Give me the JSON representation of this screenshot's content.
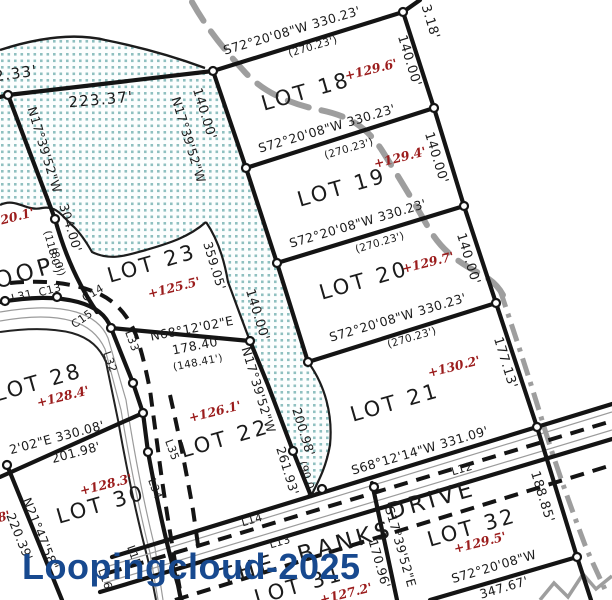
{
  "title": "Subdivision Plat Map",
  "watermark": {
    "text": "Loopingcloud-2025",
    "color": "#17498f"
  },
  "colors": {
    "line_black": "#141414",
    "stipple_teal": "#8fc0c0",
    "stream_gray": "#9e9e9e",
    "elevation_red": "#9b1c1c",
    "background": "#ffffff"
  },
  "streets": [
    "OOP",
    "THE BANKS DRIVE"
  ],
  "lots": [
    {
      "name": "LOT 18",
      "elevation": "+129.6'"
    },
    {
      "name": "LOT 19",
      "elevation": "+129.4'"
    },
    {
      "name": "LOT 20",
      "elevation": "+129.7'"
    },
    {
      "name": "LOT 21",
      "elevation": "+130.2'"
    },
    {
      "name": "LOT 22",
      "elevation": "+126.1'"
    },
    {
      "name": "LOT 23",
      "elevation": "+125.5'"
    },
    {
      "name": "LOT 28",
      "elevation": "+128.4'"
    },
    {
      "name": "LOT 30",
      "elevation": "+128.3'"
    },
    {
      "name": "LOT 31",
      "elevation": "+127.2'"
    },
    {
      "name": "LOT 32",
      "elevation": "+129.5'"
    }
  ],
  "map": {
    "labels": [
      {
        "text": "S72°20'08\"W 330.23'",
        "x": 292,
        "y": 31,
        "rot": -16.5,
        "cls": "b"
      },
      {
        "text": "(270.23')",
        "x": 313,
        "y": 47,
        "rot": -16.5,
        "cls": "p"
      },
      {
        "text": "S72°20'08\"W 330.23'",
        "x": 327,
        "y": 129,
        "rot": -16.5,
        "cls": "b"
      },
      {
        "text": "(270.23')",
        "x": 349,
        "y": 149,
        "rot": -16.5,
        "cls": "p"
      },
      {
        "text": "S72°20'08\"W 330.23'",
        "x": 358,
        "y": 224,
        "rot": -16.5,
        "cls": "b"
      },
      {
        "text": "(270.23')",
        "x": 380,
        "y": 243,
        "rot": -16.5,
        "cls": "p"
      },
      {
        "text": "S72°20'08\"W 330.23'",
        "x": 398,
        "y": 318,
        "rot": -16.5,
        "cls": "b"
      },
      {
        "text": "(270.23')",
        "x": 412,
        "y": 338,
        "rot": -16.5,
        "cls": "p"
      },
      {
        "text": "S68°12'14\"W 331.09'",
        "x": 420,
        "y": 451,
        "rot": -16.5,
        "cls": "b"
      },
      {
        "text": "N68°12'02\"E",
        "x": 192,
        "y": 329,
        "rot": -11,
        "cls": "b"
      },
      {
        "text": "178.40'",
        "x": 197,
        "y": 346,
        "rot": -11,
        "cls": "b"
      },
      {
        "text": "(148.41')",
        "x": 198,
        "y": 363,
        "rot": -11,
        "cls": "p"
      },
      {
        "text": "2'02\"E 330.08'",
        "x": 57,
        "y": 438,
        "rot": -15,
        "cls": "b"
      },
      {
        "text": "201.98'",
        "x": 76,
        "y": 453,
        "rot": -15,
        "cls": "b"
      },
      {
        "text": "S72°20'08\"W",
        "x": 494,
        "y": 567,
        "rot": -16.5,
        "cls": "b"
      },
      {
        "text": "347.67'",
        "x": 504,
        "y": 588,
        "rot": -16.5,
        "cls": "b"
      },
      {
        "text": "223.37'",
        "x": 101,
        "y": 100,
        "rot": -5,
        "cls": "D"
      },
      {
        "text": "2.33'",
        "x": 16,
        "y": 74,
        "rot": -8,
        "cls": "D"
      },
      {
        "text": "3.18'",
        "x": 430,
        "y": 22,
        "rot": 73,
        "cls": "d"
      },
      {
        "text": "140.00'",
        "x": 409,
        "y": 61,
        "rot": 73,
        "cls": "d"
      },
      {
        "text": "140.00'",
        "x": 436,
        "y": 158,
        "rot": 73,
        "cls": "d"
      },
      {
        "text": "140.00'",
        "x": 468,
        "y": 259,
        "rot": 73,
        "cls": "d"
      },
      {
        "text": "140.00'",
        "x": 204,
        "y": 114,
        "rot": 73,
        "cls": "d"
      },
      {
        "text": "140.00'",
        "x": 257,
        "y": 315,
        "rot": 73,
        "cls": "d"
      },
      {
        "text": "177.13'",
        "x": 505,
        "y": 363,
        "rot": 73,
        "cls": "d"
      },
      {
        "text": "188.85'",
        "x": 542,
        "y": 497,
        "rot": 73,
        "cls": "d"
      },
      {
        "text": "N17°39'52\"W",
        "x": 44,
        "y": 150,
        "rot": 73,
        "cls": "b"
      },
      {
        "text": "304.00'",
        "x": 70,
        "y": 228,
        "rot": 73,
        "cls": "b"
      },
      {
        "text": "(118.0')",
        "x": 52,
        "y": 252,
        "rot": 75,
        "cls": "p"
      },
      {
        "text": "N17°39'52\"W",
        "x": 188,
        "y": 140,
        "rot": 73,
        "cls": "b"
      },
      {
        "text": "359.05'",
        "x": 214,
        "y": 266,
        "rot": 73,
        "cls": "b"
      },
      {
        "text": "N17°39'52\"W",
        "x": 258,
        "y": 390,
        "rot": 73,
        "cls": "b"
      },
      {
        "text": "200.98'",
        "x": 303,
        "y": 432,
        "rot": 73,
        "cls": "b"
      },
      {
        "text": "(90.0')",
        "x": 307,
        "y": 479,
        "rot": 72,
        "cls": "p"
      },
      {
        "text": "261.93'",
        "x": 287,
        "y": 471,
        "rot": 73,
        "cls": "b"
      },
      {
        "text": "S17°39'52\"E",
        "x": 400,
        "y": 547,
        "rot": 74,
        "cls": "b"
      },
      {
        "text": "170.96'",
        "x": 379,
        "y": 564,
        "rot": 74,
        "cls": "b"
      },
      {
        "text": "N21°47'58\"",
        "x": 40,
        "y": 534,
        "rot": 68,
        "cls": "b"
      },
      {
        "text": "220.39'",
        "x": 19,
        "y": 537,
        "rot": 68,
        "cls": "b"
      },
      {
        "text": "LOT 18",
        "x": 306,
        "y": 92,
        "rot": -16,
        "cls": "L"
      },
      {
        "text": "LOT 19",
        "x": 342,
        "y": 188,
        "rot": -16,
        "cls": "L"
      },
      {
        "text": "LOT 20",
        "x": 364,
        "y": 281,
        "rot": -16,
        "cls": "L"
      },
      {
        "text": "LOT 21",
        "x": 395,
        "y": 403,
        "rot": -16,
        "cls": "L"
      },
      {
        "text": "LOT 22",
        "x": 225,
        "y": 439,
        "rot": -16,
        "cls": "L"
      },
      {
        "text": "LOT 23",
        "x": 152,
        "y": 264,
        "rot": -16,
        "cls": "L"
      },
      {
        "text": "LOT 28",
        "x": 38,
        "y": 383,
        "rot": -16,
        "cls": "L"
      },
      {
        "text": "LOT 30",
        "x": 101,
        "y": 505,
        "rot": -16,
        "cls": "L"
      },
      {
        "text": "LOT 31",
        "x": 299,
        "y": 586,
        "rot": -16,
        "cls": "L"
      },
      {
        "text": "LOT 32",
        "x": 472,
        "y": 528,
        "rot": -16,
        "cls": "L"
      },
      {
        "text": "+129.6'",
        "x": 371,
        "y": 70,
        "rot": -14,
        "cls": "r"
      },
      {
        "text": "+129.4'",
        "x": 400,
        "y": 158,
        "rot": -14,
        "cls": "r"
      },
      {
        "text": "+129.7'",
        "x": 428,
        "y": 263,
        "rot": -14,
        "cls": "r"
      },
      {
        "text": "+130.2'",
        "x": 454,
        "y": 367,
        "rot": -14,
        "cls": "r"
      },
      {
        "text": "+126.1'",
        "x": 215,
        "y": 412,
        "rot": -14,
        "cls": "r"
      },
      {
        "text": "+125.5'",
        "x": 174,
        "y": 288,
        "rot": -14,
        "cls": "r"
      },
      {
        "text": "+128.4'",
        "x": 63,
        "y": 397,
        "rot": -14,
        "cls": "r"
      },
      {
        "text": "+128.3'",
        "x": 106,
        "y": 485,
        "rot": -14,
        "cls": "r"
      },
      {
        "text": "+127.2'",
        "x": 346,
        "y": 594,
        "rot": -14,
        "cls": "r"
      },
      {
        "text": "+129.5'",
        "x": 480,
        "y": 543,
        "rot": -14,
        "cls": "r"
      },
      {
        "text": "+120.1'",
        "x": 8,
        "y": 219,
        "rot": -14,
        "cls": "r"
      },
      {
        "text": "8'",
        "x": 4,
        "y": 517,
        "rot": -14,
        "cls": "r"
      },
      {
        "text": "L31",
        "x": 22,
        "y": 296,
        "rot": -14,
        "cls": "s"
      },
      {
        "text": "C13",
        "x": 50,
        "y": 290,
        "rot": -14,
        "cls": "s"
      },
      {
        "text": "C14",
        "x": 93,
        "y": 293,
        "rot": -30,
        "cls": "s"
      },
      {
        "text": "C15",
        "x": 82,
        "y": 319,
        "rot": -35,
        "cls": "s"
      },
      {
        "text": "L33",
        "x": 132,
        "y": 341,
        "rot": 70,
        "cls": "s"
      },
      {
        "text": "L32",
        "x": 110,
        "y": 362,
        "rot": 70,
        "cls": "s"
      },
      {
        "text": "L35",
        "x": 172,
        "y": 450,
        "rot": 70,
        "cls": "s"
      },
      {
        "text": "L34",
        "x": 155,
        "y": 489,
        "rot": 70,
        "cls": "s"
      },
      {
        "text": "L15",
        "x": 134,
        "y": 556,
        "rot": 70,
        "cls": "s"
      },
      {
        "text": "L16",
        "x": 105,
        "y": 579,
        "rot": 70,
        "cls": "s"
      },
      {
        "text": "L14",
        "x": 252,
        "y": 520,
        "rot": -16,
        "cls": "s"
      },
      {
        "text": "L13",
        "x": 280,
        "y": 542,
        "rot": -16,
        "cls": "s"
      },
      {
        "text": "L12",
        "x": 462,
        "y": 469,
        "rot": -16,
        "cls": "s"
      },
      {
        "text": "(8.0')",
        "x": 57,
        "y": 262,
        "rot": 72,
        "cls": "p"
      },
      {
        "text": "OOP",
        "x": 25,
        "y": 274,
        "rot": -16,
        "cls": "S"
      },
      {
        "text": "THE  BANKS",
        "x": 307,
        "y": 554,
        "rot": -16,
        "cls": "S"
      },
      {
        "text": "DRIVE",
        "x": 432,
        "y": 501,
        "rot": -16,
        "cls": "S"
      }
    ]
  }
}
